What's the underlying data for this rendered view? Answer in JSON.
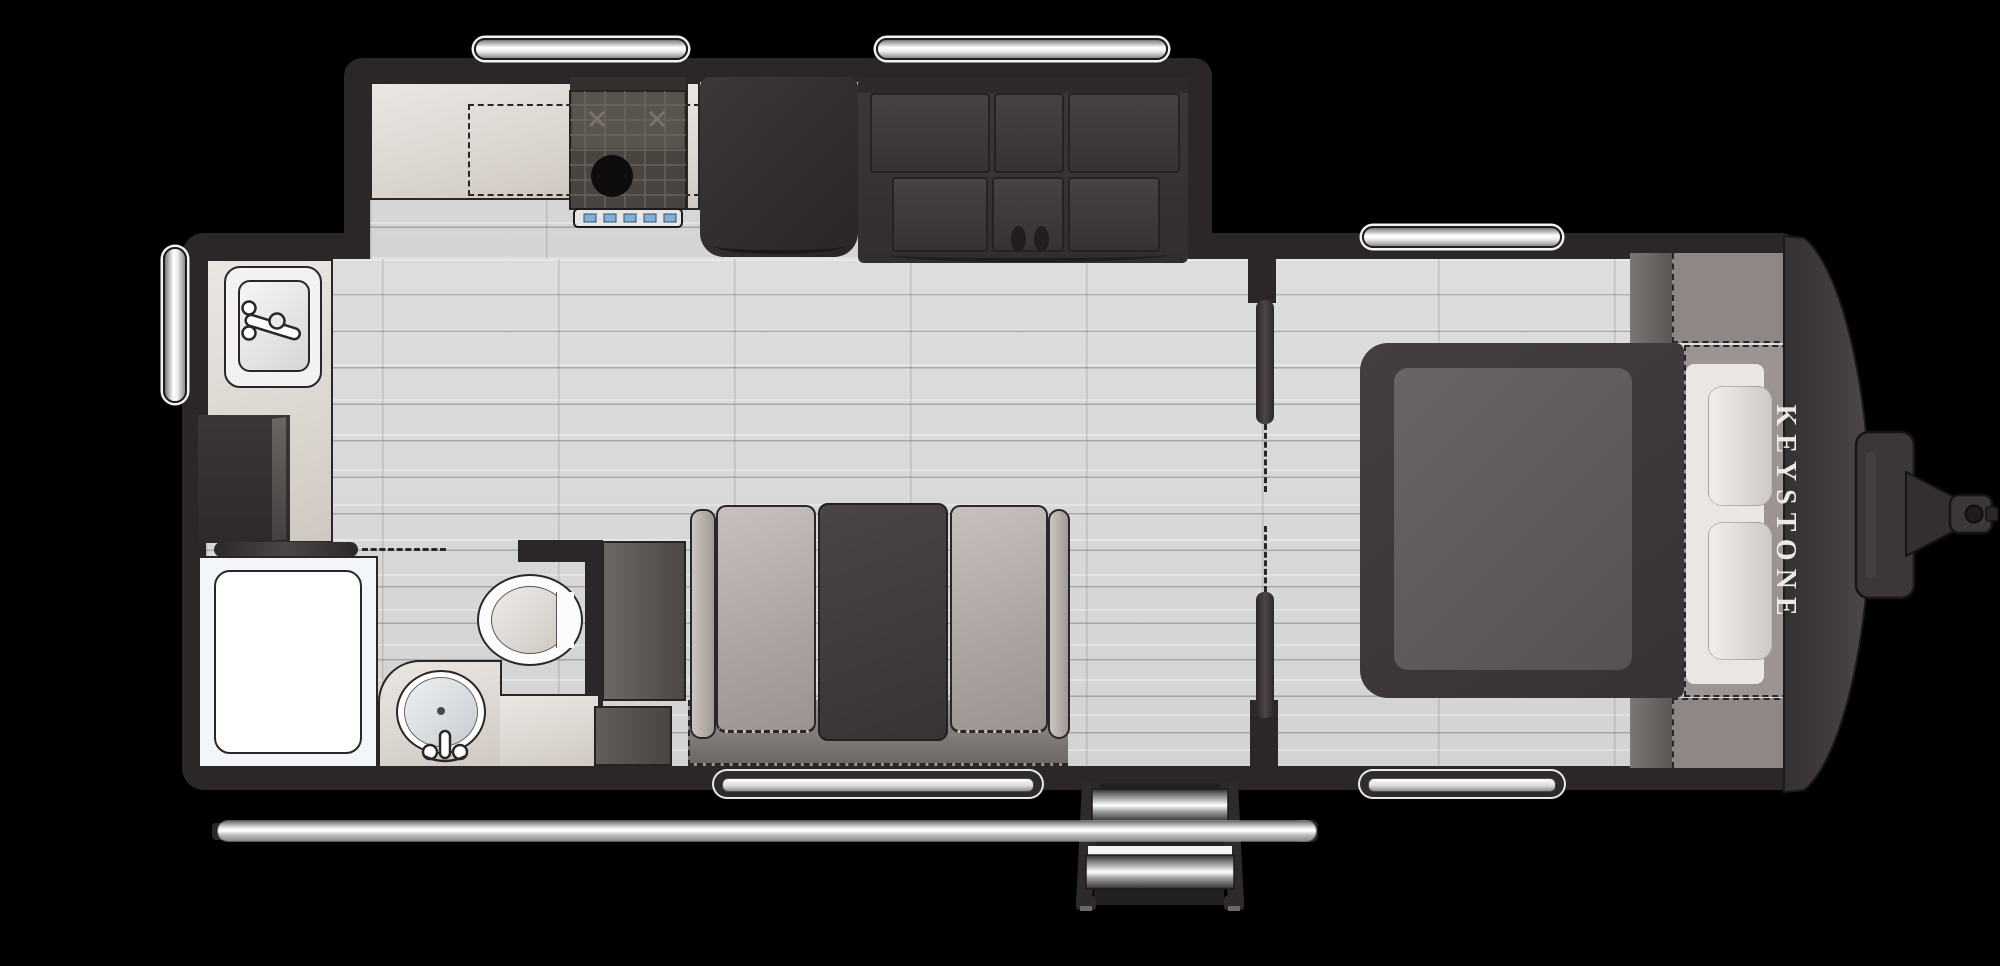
{
  "canvas": {
    "width": 2000,
    "height": 966,
    "background": "#000000"
  },
  "branding": {
    "logo_text": "KEYSTONE",
    "logo_color": "#EFE9E3"
  },
  "palette": {
    "wall": "#2B2728",
    "floor_plank": "#D9D9D9",
    "counter_beige": "#E6E1DC",
    "dark_cabinet": "#3B3537",
    "sofa_cushion": "#BDB6B2",
    "sofa_console": "#433D3F",
    "mattress_gray": "#625C5F",
    "pillow_light": "#ECE9E7",
    "overhead_cabinet_gray": "#8F8785",
    "window_chrome": "#FFFFFF",
    "stove_knob_blue": "#7FB2D6"
  },
  "elements": [
    "galley-window",
    "living-window",
    "bedroom-window-top",
    "bedroom-window-bottom",
    "sofa-window",
    "side-window",
    "kitchen-sink",
    "range-stove",
    "overhead-cabinet-dashed",
    "refrigerator",
    "entertainment-cabinet",
    "pantry-cabinet",
    "bathroom-pocket-door",
    "shower",
    "toilet",
    "vanity-counter",
    "vanity-sink",
    "storage-cabinets",
    "tri-fold-sofa",
    "bedroom-pocket-doors",
    "bed-platform",
    "mattress",
    "pillows",
    "bedroom-overhead-cabinets",
    "front-cap",
    "hitch-tongue",
    "entry-steps",
    "awning-rail"
  ]
}
